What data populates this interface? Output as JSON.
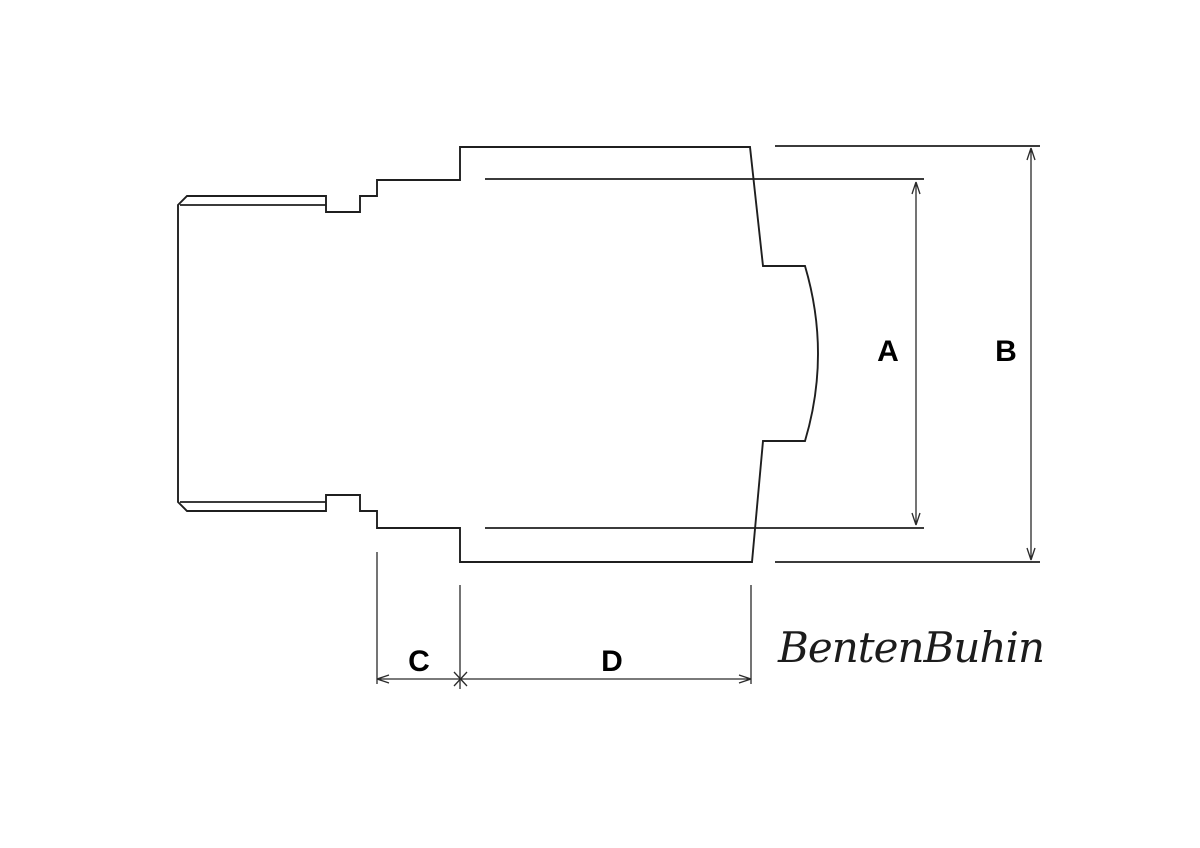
{
  "canvas": {
    "width": 1200,
    "height": 848,
    "background_color": "#ffffff",
    "line_color": "#1f1f1f",
    "label_color": "#000000"
  },
  "watermark": {
    "text": "BentenBuhin"
  },
  "diagram": {
    "type": "technical-dimension-drawing",
    "description": "Side profile of a stepped fitting: threaded left section, notched collar, larger right body shown broken with a bulged inner curve; dimensioned A, B (vertical) and C, D (horizontal).",
    "labels": {
      "A": "A",
      "B": "B",
      "C": "C",
      "D": "D"
    },
    "paths": [
      {
        "name": "part-outline",
        "d": "M 187 196 L 326 196 L 326 212 L 360 212 L 360 196 L 377 196 L 377 180 L 460 180 L 460 147 L 750 147 L 763 266 L 805 266 Q 831 354 805 441 L 763 441 L 752 562 L 460 562 L 460 528 L 377 528 L 377 511 L 360 511 L 360 495 L 326 495 L 326 511 L 187 511 L 178 502 L 178 205 Z"
      },
      {
        "name": "thread-line-top",
        "d": "M 180 205 L 326 205"
      },
      {
        "name": "thread-line-bottom",
        "d": "M 180 502 L 326 502"
      },
      {
        "name": "body-top-right-edge",
        "d": "M 775 146 L 1040 146"
      },
      {
        "name": "body-bottom-right-edge",
        "d": "M 775 562 L 1040 562"
      },
      {
        "name": "inner-edge-top",
        "d": "M 485 179 L 924 179"
      },
      {
        "name": "inner-edge-bottom",
        "d": "M 485 528 L 924 528"
      },
      {
        "name": "dim-line-A",
        "d": "M 916 182 L 916 525 M 916 182 L 912 194 M 916 182 L 920 194 M 916 525 L 912 513 M 916 525 L 920 513"
      },
      {
        "name": "dim-line-B",
        "d": "M 1031 148 L 1031 560 M 1031 148 L 1027 160 M 1031 148 L 1035 160 M 1031 560 L 1027 548 M 1031 560 L 1035 548"
      },
      {
        "name": "dim-line-CD",
        "d": "M 377 679 L 751 679 M 377 679 L 389 675 M 377 679 L 389 683 M 751 679 L 739 675 M 751 679 L 739 683 M 454 672 L 467 686 M 467 672 L 454 686"
      },
      {
        "name": "ext-line-C-left",
        "d": "M 377 552 L 377 684"
      },
      {
        "name": "ext-line-CD-mid",
        "d": "M 460 585 L 460 689"
      },
      {
        "name": "ext-line-D-right",
        "d": "M 751 585 L 751 684"
      }
    ]
  }
}
